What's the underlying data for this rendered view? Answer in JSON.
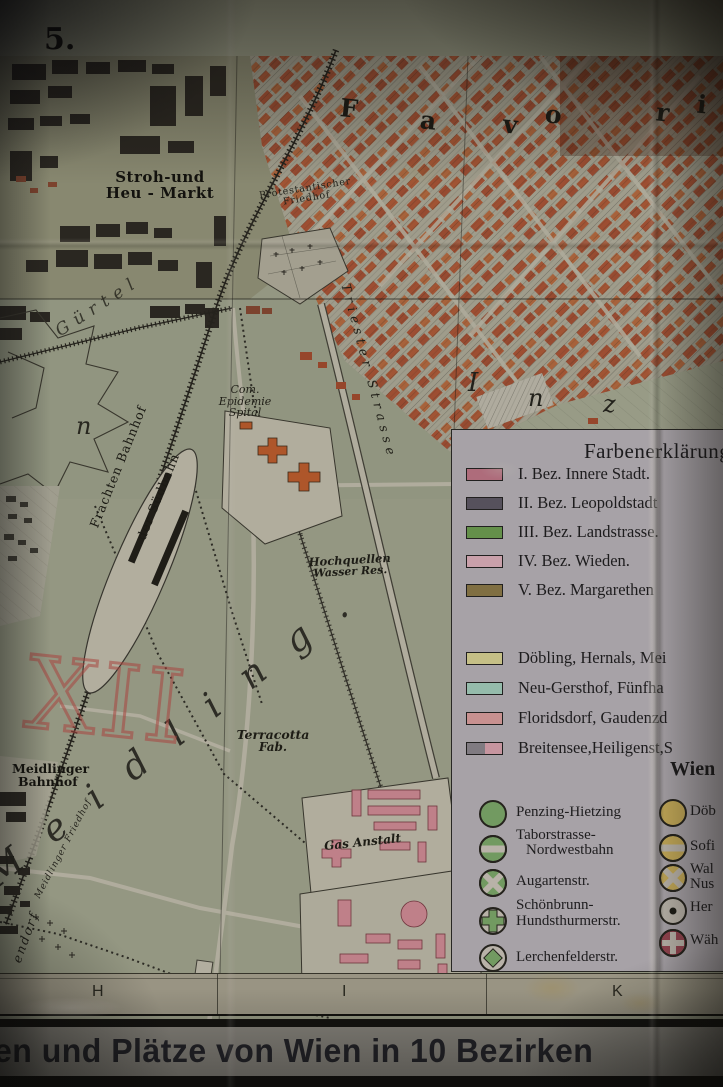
{
  "colors": {
    "map_paper": "#a6aa94",
    "legend_paper": "#bcb7be",
    "symbol_paper": "#cfcabf",
    "station_green": "#7fae6e",
    "station_yellow": "#d9bd62",
    "station_red": "#a24a58",
    "building_red": "#b05233",
    "building_pink": "#d7909b",
    "title_ink": "#23242b"
  },
  "map": {
    "sheet_number": "5.",
    "labels": {
      "stroh_line1": "Stroh-und",
      "stroh_line2": "Heu - Markt",
      "prot_friedhof_line1": "Protestantischer",
      "prot_friedhof_line2": "Friedhof",
      "epidemie_line1": "Com.",
      "epidemie_line2": "Epidemie",
      "epidemie_line3": "Spital",
      "frachten_line1": "Frachten Bahnhof",
      "frachten_line2": "der Südbahn",
      "triester": "Triester Strasse",
      "hochquellen_line1": "Hochquellen",
      "hochquellen_line2": "Wasser Res.",
      "guertel": "Gürtel",
      "letter_n": "n",
      "terracotta_line1": "Terracotta",
      "terracotta_line2": "Fab.",
      "meidlinger_bhf_line1": "Meidlinger",
      "meidlinger_bhf_line2": "Bahnhof",
      "meidlinger_friedhof": "Meidlinger Friedhof",
      "gas_anstalt": "Gas Anstalt",
      "endorf": "endorf",
      "meidling": "M e i d l i n g .",
      "handwritten_xii": "XII"
    },
    "favoriten_letters": [
      "F",
      "a",
      "v",
      "o",
      "r",
      "i",
      "t"
    ],
    "inz_letters": [
      "I",
      "n",
      "z"
    ]
  },
  "legend": {
    "title": "Farbenerklärung",
    "districts": [
      {
        "label": "I. Bez. Innere Stadt.",
        "color": "#c4798c"
      },
      {
        "label": "II. Bez. Leopoldstadt",
        "color": "#5f5a68"
      },
      {
        "label": "III. Bez. Landstrasse.",
        "color": "#6fa353"
      },
      {
        "label": "IV. Bez. Wieden.",
        "color": "#e3b5c2"
      },
      {
        "label": "V. Bez. Margarethen",
        "color": "#8f7d4a"
      }
    ],
    "vororte": [
      {
        "label": "Döbling, Hernals, Mei",
        "color": "#ded898"
      },
      {
        "label": "Neu-Gersthof, Fünfha",
        "color": "#a7d4c3"
      },
      {
        "label": "Floridsdorf, Gaudenzd",
        "color": "#e2a4a4"
      },
      {
        "label": "Breitensee,Heiligenst,S",
        "color": "#8f8a92",
        "color2": "#dfa8b5"
      }
    ],
    "wien_heading": "Wien",
    "stations_left": [
      {
        "label": "Penzing-Hietzing",
        "color": "#7fae6e"
      },
      {
        "label": "Taborstrasse-",
        "label2": "Nordwestbahn",
        "color": "#7fae6e"
      },
      {
        "label": "Augartenstr.",
        "color": "#7fae6e"
      },
      {
        "label": "Schönbrunn-",
        "label2": "Hundsthurmerstr.",
        "color": "#7fae6e"
      },
      {
        "label": "Lerchenfelderstr.",
        "color": "#7fae6e"
      }
    ],
    "stations_right": [
      {
        "label": "Döb",
        "color": "#d9bd62"
      },
      {
        "label": "Sofi",
        "color": "#d9bd62"
      },
      {
        "label": "Wal",
        "label2": "Nus",
        "color": "#d9bd62"
      },
      {
        "label": "Her",
        "color": "#cfcabf"
      },
      {
        "label": "Wäh",
        "color": "#a24a58"
      }
    ]
  },
  "grid_row": {
    "letters": [
      "H",
      "I",
      "K"
    ]
  },
  "title_bar": {
    "text": "en und Plätze von Wien in 10 Bezirken"
  }
}
